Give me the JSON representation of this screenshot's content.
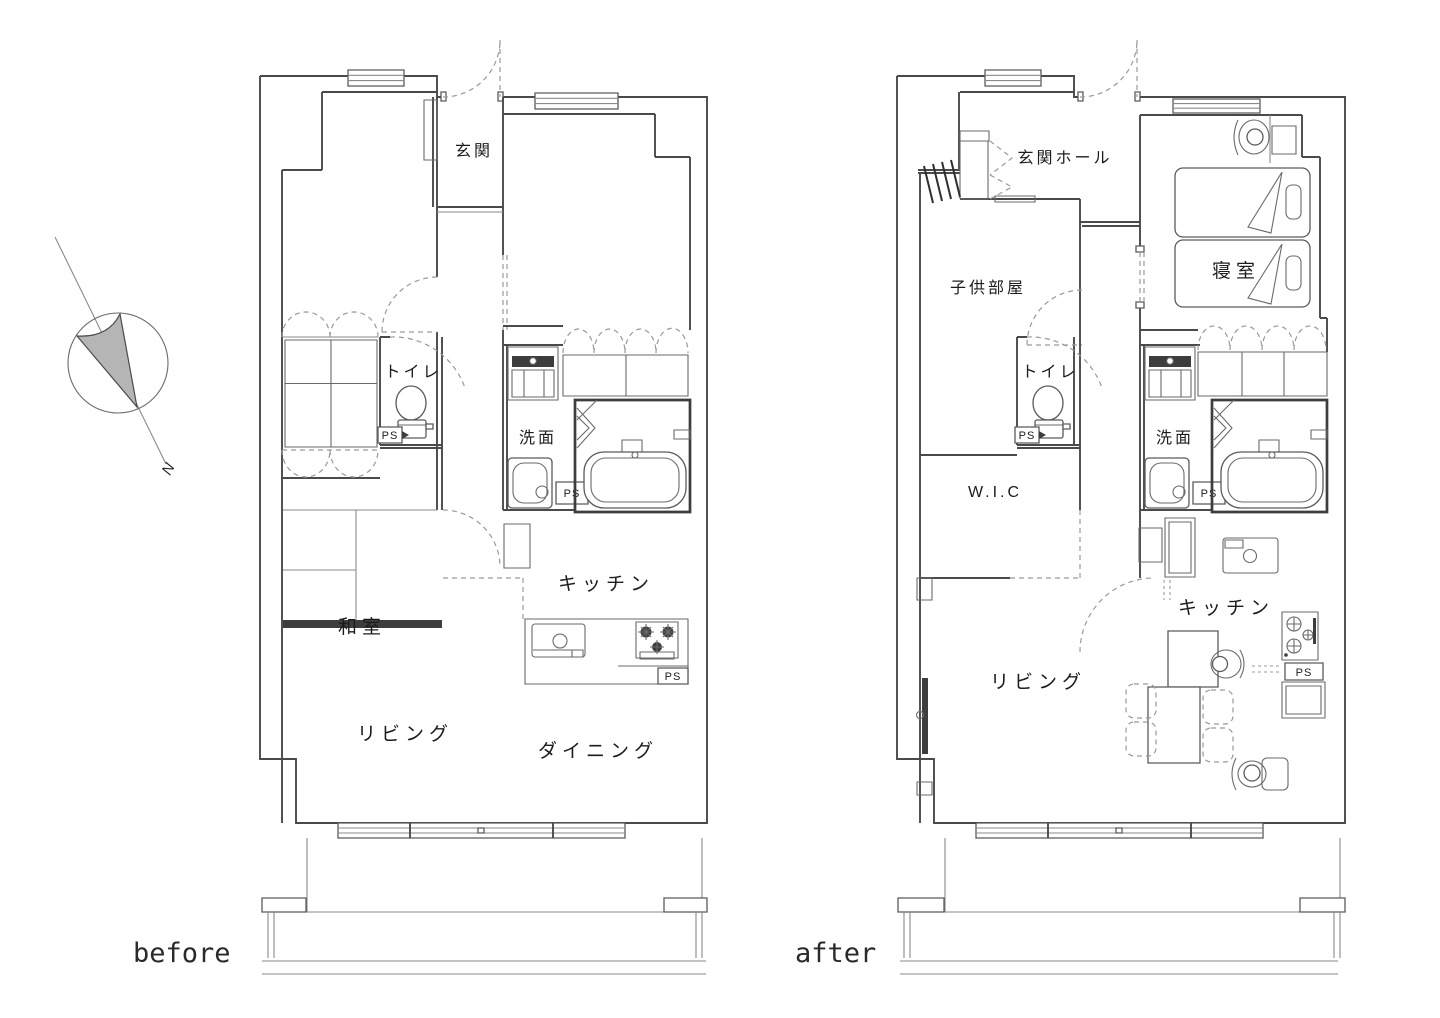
{
  "captions": {
    "before": "before",
    "after": "after"
  },
  "compass": {
    "north_label": "N"
  },
  "colors": {
    "wall": "#4a4a4a",
    "dark_fill": "#3d3d3d",
    "compass_fill": "#b5b5b5",
    "background": "#ffffff"
  },
  "plan_before": {
    "rooms": {
      "genkan": "玄関",
      "toilet": "トイレ",
      "washroom": "洗面",
      "washitsu": "和室",
      "kitchen": "キッチン",
      "living": "リビング",
      "dining": "ダイニング"
    },
    "ps_labels": [
      "PS",
      "PS",
      "PS"
    ]
  },
  "plan_after": {
    "rooms": {
      "entrance_hall": "玄関ホール",
      "kids_room": "子供部屋",
      "bedroom": "寝室",
      "toilet": "トイレ",
      "washroom": "洗面",
      "wic": "W.I.C",
      "kitchen": "キッチン",
      "living": "リビング"
    },
    "ps_labels": [
      "PS",
      "PS",
      "PS"
    ]
  }
}
